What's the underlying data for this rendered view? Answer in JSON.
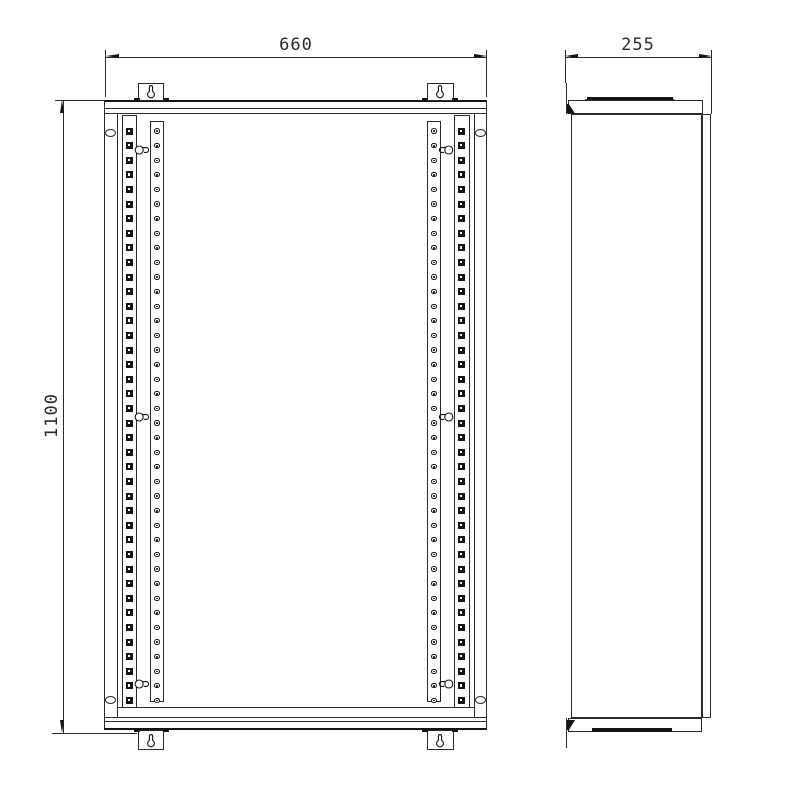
{
  "drawing": {
    "type": "orthographic technical drawing, two views",
    "views": {
      "front": {
        "label_width": "660",
        "label_height": "1100"
      },
      "side": {
        "label_depth": "255"
      }
    },
    "dimensions": [
      {
        "name": "width",
        "value": "660"
      },
      {
        "name": "height",
        "value": "1100"
      },
      {
        "name": "depth",
        "value": "255"
      }
    ],
    "rails": {
      "square_hole_count": 40,
      "round_hole_count": 40,
      "first_y": 131,
      "spacing": 14.6,
      "square_cols": [
        129.5,
        461.5
      ],
      "round_cols": [
        157,
        434
      ],
      "keyhole_y": [
        150,
        416.5,
        683.5
      ],
      "keyhole_left_x": 134,
      "keyhole_right_x": 437.5
    },
    "colors": {
      "line": "#2a2a2a",
      "dark": "#141414",
      "bg": "#ffffff"
    }
  }
}
